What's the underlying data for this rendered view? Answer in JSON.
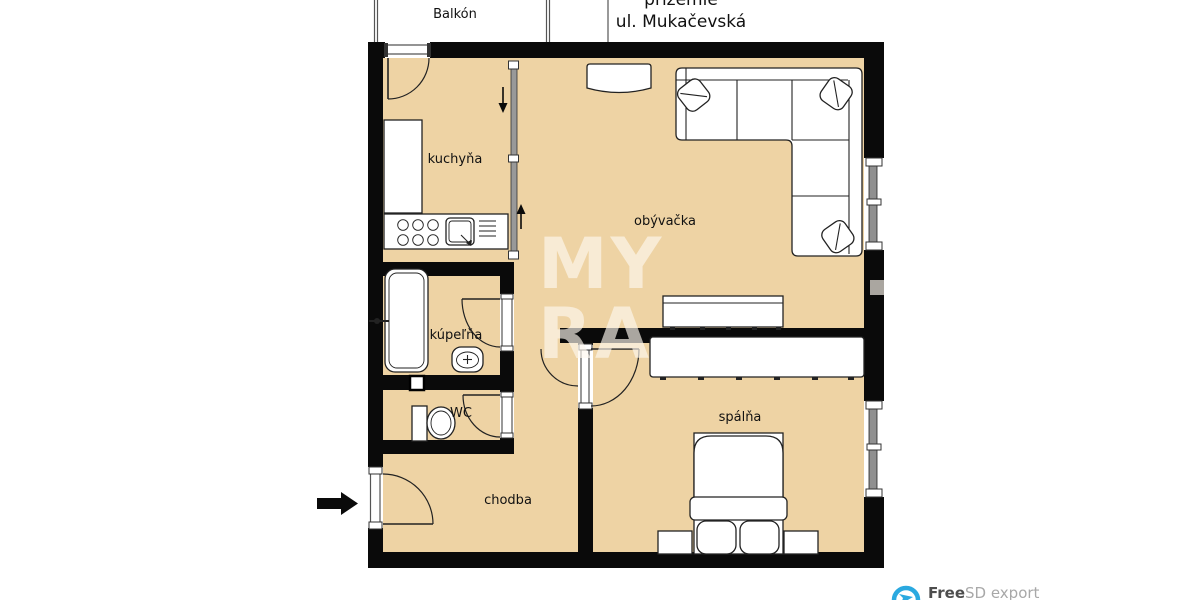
{
  "title": {
    "floor_line": "prízemie",
    "street_line": "ul. Mukačevská"
  },
  "rooms": {
    "balkon": {
      "label": "Balkón"
    },
    "kuchyna": {
      "label": "kuchyňa"
    },
    "obyvacka": {
      "label": "obývačka"
    },
    "kupelna": {
      "label": "kúpeľňa"
    },
    "wc": {
      "label": "WC"
    },
    "chodba": {
      "label": "chodba"
    },
    "spalna": {
      "label": "spálňa"
    }
  },
  "watermark": {
    "line1": "MY",
    "line2": "RA"
  },
  "footer": {
    "brand_bold": "Free",
    "brand_rest": "SD export"
  },
  "icons": {
    "entry_arrow": "arrow-right",
    "kitchen_pass_arrow": "arrow-down",
    "living_pass_arrow": "arrow-up",
    "logo_mark": "circle-plane"
  },
  "colors": {
    "floor": "#eed3a4",
    "wall": "#0a0a0a",
    "watermark": "#fdf8ee",
    "window_glass": "#909090",
    "logo_blue": "#2aa9e0"
  }
}
